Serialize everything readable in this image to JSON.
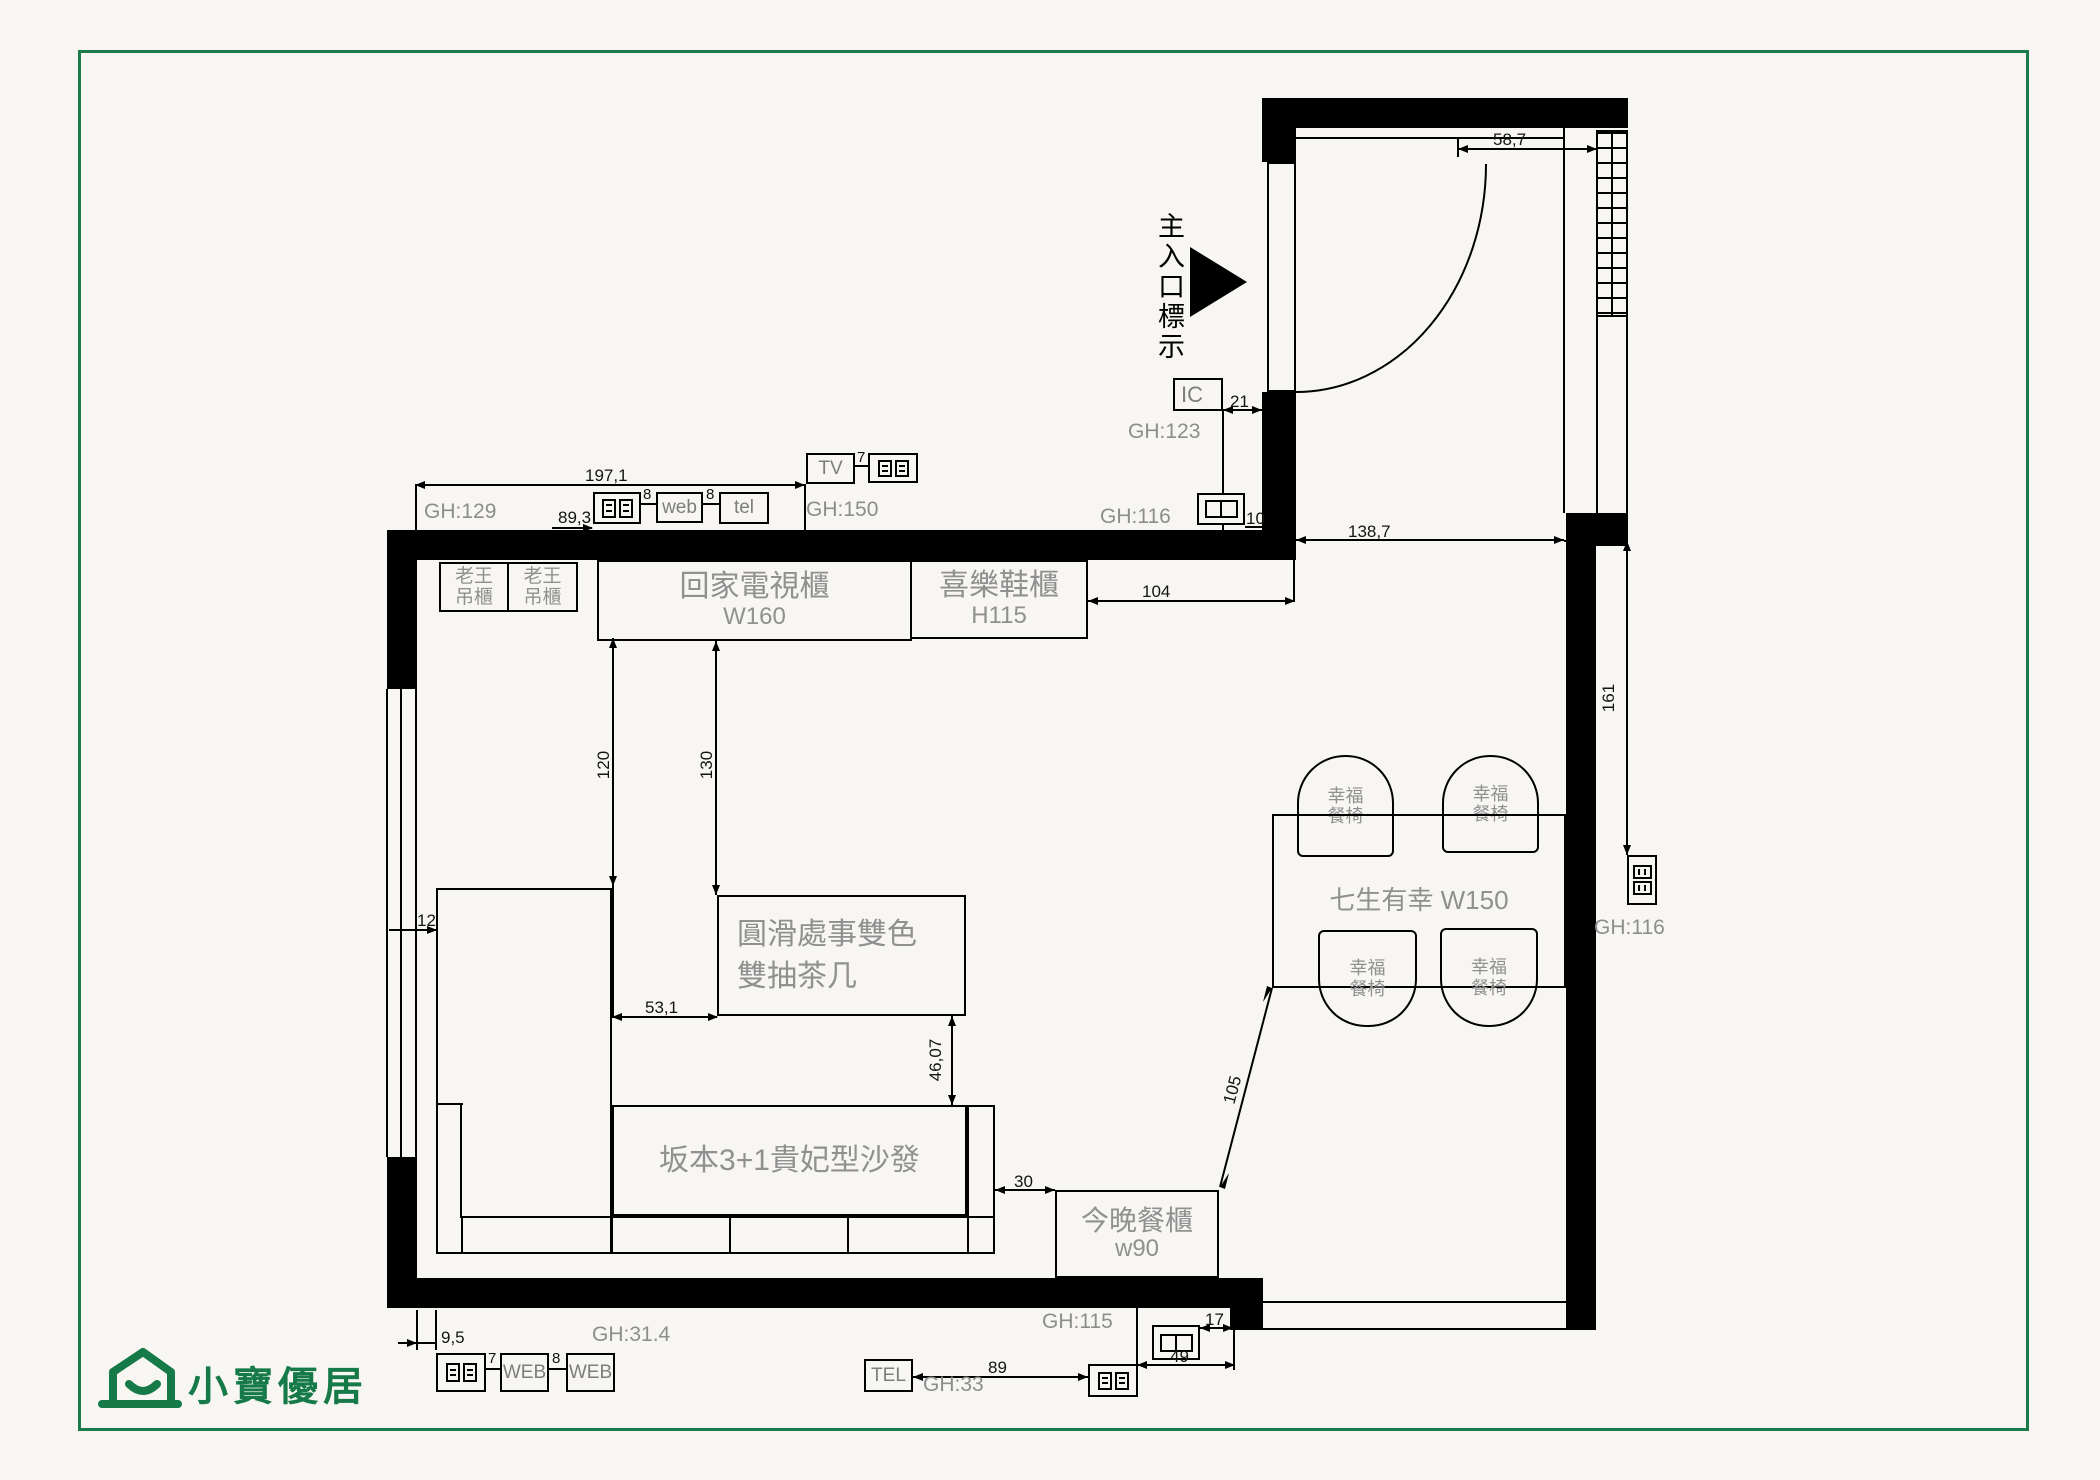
{
  "colors": {
    "background": "#f7f6f3",
    "frame_green": "#1b7b4b",
    "logo_green": "#157a47",
    "line_black": "#000000",
    "label_grey": "#8d8d8d"
  },
  "logo": {
    "text": "小寶優居"
  },
  "entrance": {
    "label": "主入口標示"
  },
  "furniture": {
    "hanging_cabinet_left": {
      "line1": "老王",
      "line2": "吊櫃"
    },
    "hanging_cabinet_right": {
      "line1": "老王",
      "line2": "吊櫃"
    },
    "tv_cabinet": {
      "name": "回家電視櫃",
      "size": "W160"
    },
    "shoe_cabinet": {
      "name": "喜樂鞋櫃",
      "size": "H115"
    },
    "coffee_table": {
      "line1": "圓滑處事雙色",
      "line2": "雙抽茶几"
    },
    "sofa": {
      "name": "坂本3+1貴妃型沙發"
    },
    "dining_table": {
      "name": "七生有幸 W150"
    },
    "dining_chair": {
      "line1": "幸福",
      "line2": "餐椅"
    },
    "sideboard": {
      "name": "今晚餐櫃",
      "size": "w90"
    }
  },
  "wall_labels": {
    "gh129": "GH:129",
    "gh150": "GH:150",
    "gh123": "GH:123",
    "gh116_top": "GH:116",
    "gh116_right": "GH:116",
    "gh115": "GH:115",
    "gh314": "GH:31.4",
    "gh33": "GH:33"
  },
  "ports": {
    "web": "web",
    "tel": "tel",
    "tv": "TV",
    "ic": "IC",
    "web_lower_1": "WEB",
    "web_lower_2": "WEB",
    "tel_lower": "TEL"
  },
  "dimensions": {
    "top_width": "197,1",
    "top_left_offset": "89,3",
    "gap_outlet_web": "8",
    "gap_web_tel": "8",
    "gap_tv_outlet": "7",
    "door_to_wall": "58,7",
    "ic_to_wall": "21",
    "outlet_to_wall": "10",
    "shoe_to_wall": "104",
    "entry_width": "138,7",
    "right_wall_height": "161",
    "tv_to_chaise": "120",
    "tv_to_table": "130",
    "window_to_sofa": "12",
    "chaise_to_table": "53,1",
    "table_to_sofa": "46,07",
    "sofa_to_sideboard": "30",
    "table_to_sideboard": "105",
    "wall_to_outlet": "9,5",
    "gap_outlet_web_lower": "7",
    "gap_web_web_lower": "8",
    "floor_outlet_to_wall": "17",
    "floor_outlet_width": "49",
    "tel_to_outlet": "89"
  }
}
